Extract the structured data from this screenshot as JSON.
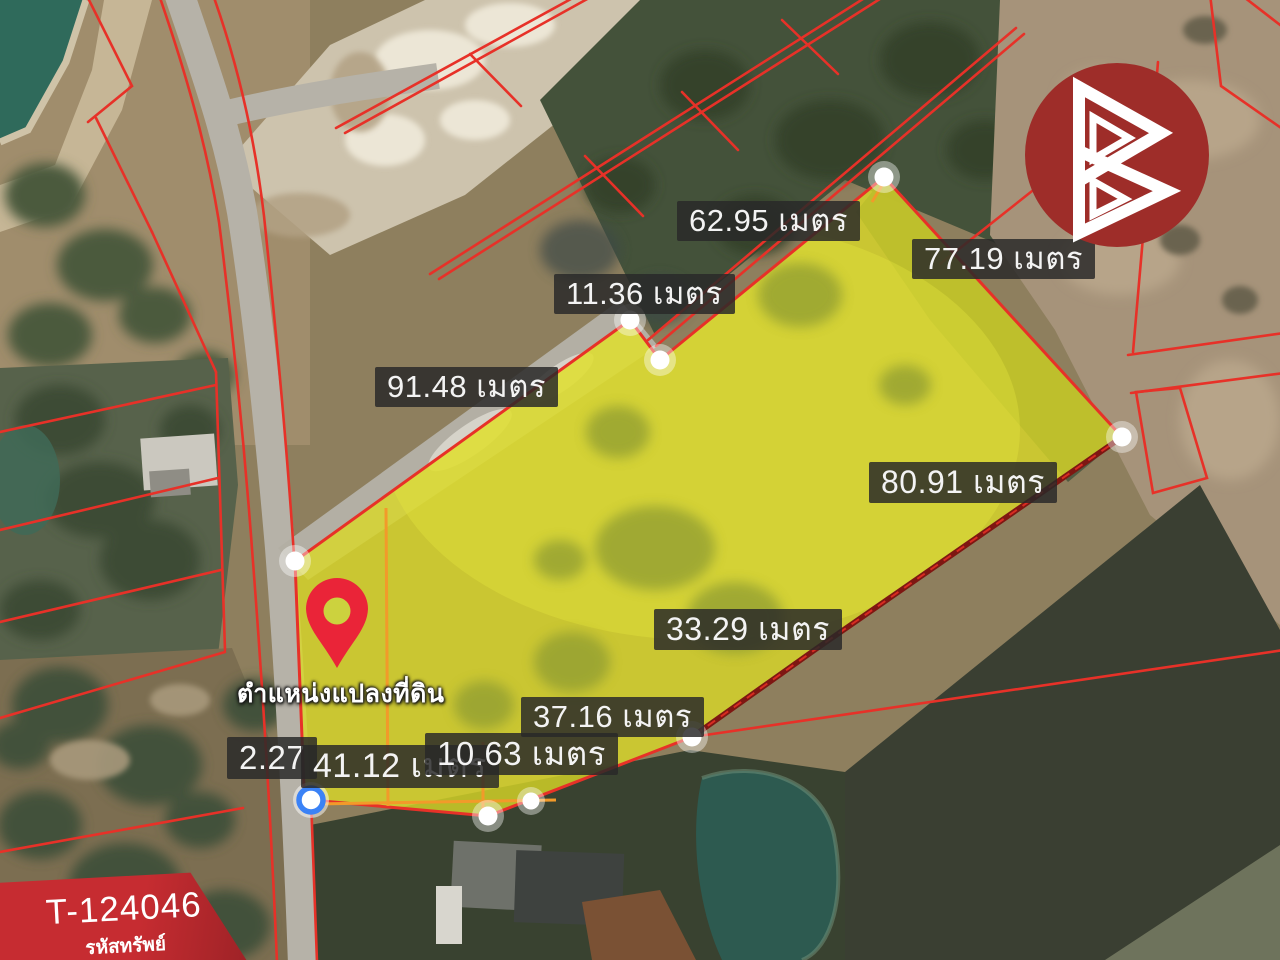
{
  "map": {
    "marker_label": "ตำแหน่งแปลงที่ดิน",
    "measurements": [
      {
        "id": "top-edge",
        "text": "62.95 เมตร",
        "value_m": 62.95
      },
      {
        "id": "upper-right",
        "text": "77.19 เมตร",
        "value_m": 77.19
      },
      {
        "id": "notch-edge",
        "text": "11.36 เมตร",
        "value_m": 11.36
      },
      {
        "id": "upper-left",
        "text": "91.48 เมตร",
        "value_m": 91.48
      },
      {
        "id": "right-edge",
        "text": "80.91 เมตร",
        "value_m": 80.91
      },
      {
        "id": "lower-right",
        "text": "33.29 เมตร",
        "value_m": 33.29
      },
      {
        "id": "bottom-edge",
        "text": "37.16 เมตร",
        "value_m": 37.16
      },
      {
        "id": "left-small",
        "text": "2.27",
        "value_m": 2.27
      },
      {
        "id": "bottom-left",
        "text": "41.12 เมตร",
        "value_m": 41.12
      },
      {
        "id": "bottom-mid",
        "text": "10.63 เมตร",
        "value_m": 10.63
      }
    ]
  },
  "badge": {
    "code": "T-124046",
    "caption": "รหัสทรัพย์"
  },
  "watermark": {
    "icon": "b-triangle-logo"
  },
  "colors": {
    "brand_red": "#9e2d29",
    "badge_red": "#c62c31",
    "cadastral_red": "#e73128",
    "parcel_fill_yellow": "#d9d827",
    "parcel_inner_orange": "#f29a2a",
    "marker_red": "#ea2438",
    "marker_ring_blue": "#3b82f6",
    "label_bg": "#282828"
  }
}
